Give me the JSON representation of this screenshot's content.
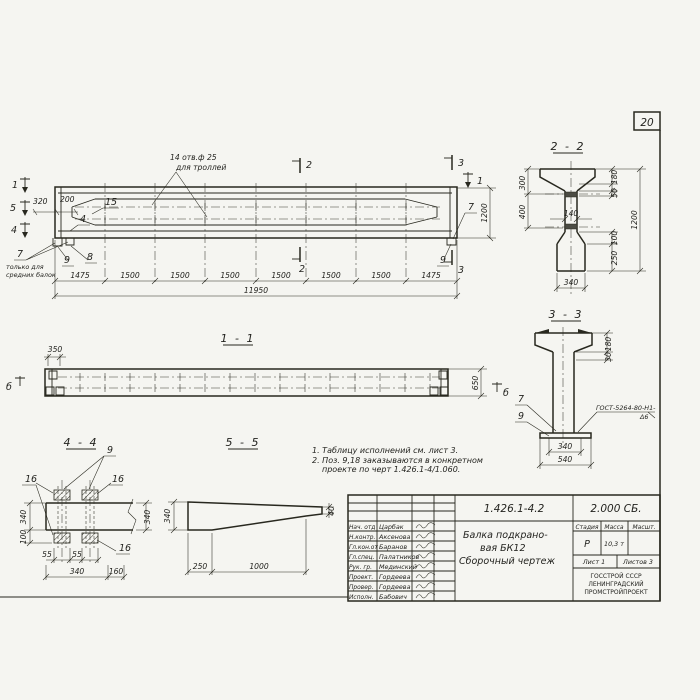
{
  "sheet": {
    "page_number": "20"
  },
  "main_view": {
    "note_holes_1": "14 отв.ф 25",
    "note_holes_2": "для троллей",
    "marker_1": "1",
    "marker_5": "5",
    "marker_4": "4",
    "marker_2": "2",
    "marker_3": "3",
    "dim_320": "320",
    "dim_200": "200",
    "pos_15": "15",
    "pos_4": "4",
    "pos_7": "7",
    "pos_7_note_1": "только для",
    "pos_7_note_2": "средних балок",
    "pos_9": "9",
    "pos_8": "8",
    "pos_7_right": "7",
    "pos_9_right": "9",
    "dim_1200": "1200",
    "dims_bottom": [
      "1475",
      "1500",
      "1500",
      "1500",
      "1500",
      "1500",
      "1500",
      "1475"
    ],
    "dim_total": "11950"
  },
  "section_2_2": {
    "title": "2 - 2",
    "dim_300": "300",
    "dim_400": "400",
    "dim_140": "140",
    "dim_180": "180",
    "dim_50": "50",
    "dim_1200": "1200",
    "dim_100": "100",
    "dim_250": "250",
    "dim_340": "340"
  },
  "section_3_3": {
    "title": "3 - 3",
    "dim_180": "180",
    "dim_30": "30",
    "dim_340": "340",
    "dim_540": "540",
    "pos_7": "7",
    "pos_9": "9",
    "weld_note_1": "ГОСТ-5264-80-Н1-",
    "weld_note_2": "Δ6"
  },
  "view_1_1": {
    "title": "1 - 1",
    "dim_350": "350",
    "dim_650": "650",
    "marker_b": "б"
  },
  "view_4_4": {
    "title": "4 - 4",
    "pos_9": "9",
    "pos_16": "16",
    "dim_340_left": "340",
    "dim_100": "100",
    "dim_340_right": "340",
    "dim_55_1": "55",
    "dim_55_2": "55",
    "dim_340_bottom": "340",
    "dim_160": "160"
  },
  "view_5_5": {
    "title": "5 - 5",
    "dim_340": "340",
    "dim_250": "250",
    "dim_1000": "1000",
    "dim_40": "40"
  },
  "notes": {
    "line_1": "1. Таблицу исполнений см. лист 3.",
    "line_2": "2. Поз. 9,18 заказываются в конкретном",
    "line_3": "проекте по черт 1.426.1-4/1.060."
  },
  "title_block": {
    "doc_number": "1.426.1-4.2",
    "doc_code": "2.000 СБ.",
    "signature_rows": [
      {
        "role": "Нач. отд",
        "name": "Царбак"
      },
      {
        "role": "Н.контр.",
        "name": "Аксенова"
      },
      {
        "role": "Гл.кон.от",
        "name": "Баранов"
      },
      {
        "role": "Гл.спец.",
        "name": "Палатников"
      },
      {
        "role": "Рук. гр.",
        "name": "Мединский"
      },
      {
        "role": "Проект.",
        "name": "Гордеева"
      },
      {
        "role": "Провер.",
        "name": "Гордеева"
      },
      {
        "role": "Исполн.",
        "name": "Бабович"
      }
    ],
    "title_line_1": "Балка подкрано-",
    "title_line_2": "вая БК12",
    "title_line_3": "Сборочный чертеж",
    "col_stage": "Стадия",
    "col_mass": "Масса",
    "col_scale": "Масшт.",
    "stage_value": "Р",
    "mass_value": "10,3 т",
    "sheet_info": "Лист 1",
    "sheets_info": "Листов 3",
    "org_line_1": "ГОССТРОЙ СССР",
    "org_line_2": "ЛЕНИНГРАДСКИЙ",
    "org_line_3": "ПРОМСТРОЙПРОЕКТ"
  }
}
